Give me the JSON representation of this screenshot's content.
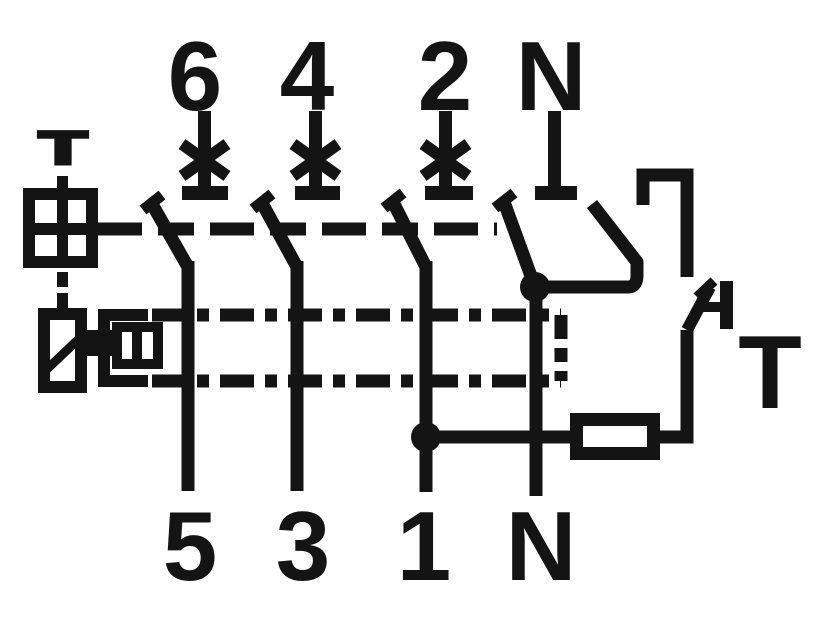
{
  "labels": {
    "top_terminals": [
      "6",
      "4",
      "2",
      "N"
    ],
    "bottom_terminals": [
      "5",
      "3",
      "1",
      "N"
    ],
    "left_test_marker": "T",
    "test_button_label": "T"
  },
  "icons": {
    "overcurrent_release": "x-cross",
    "junction": "filled-dot",
    "test_resistor": "outlined-rectangle",
    "test_button": "push-contact",
    "mechanical_coupling": "dash-dot-line",
    "test_winding": "crossed-square",
    "residual_current_release": "rectangle-with-diagonal"
  },
  "colors": {
    "ink": "#141414",
    "background": "#ffffff"
  }
}
